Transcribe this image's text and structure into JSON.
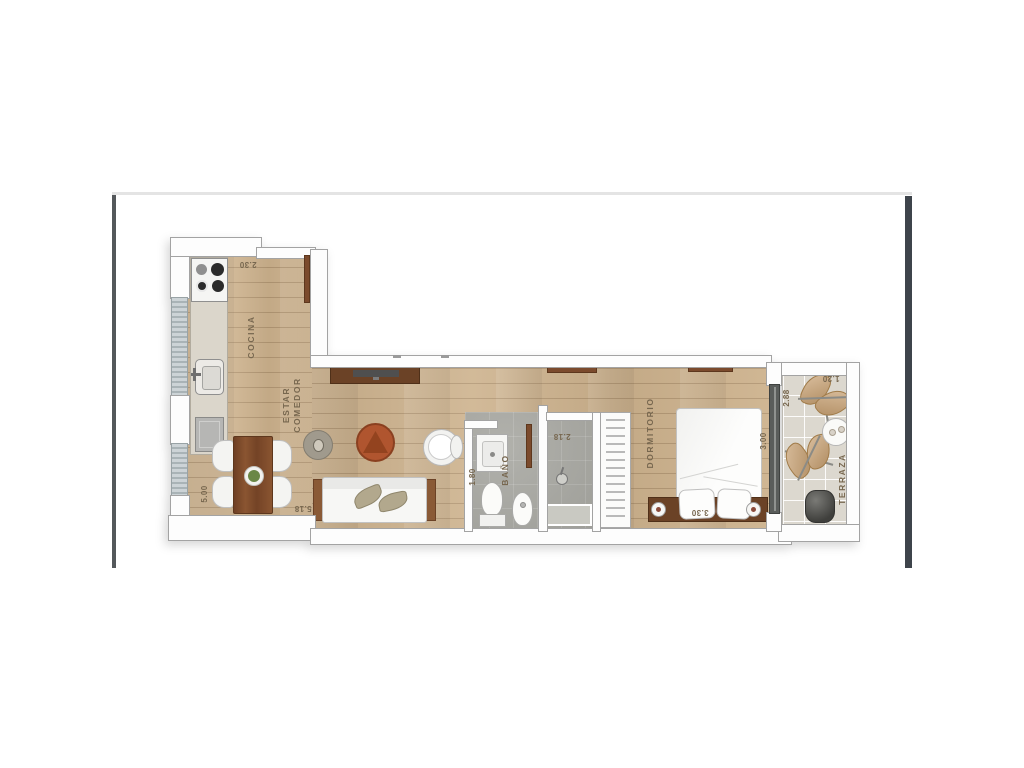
{
  "image_type": "apartment-floorplan-photo",
  "rooms": {
    "cocina": {
      "name": "COCINA",
      "width": "2.30"
    },
    "estar_comedor": {
      "name_line1": "ESTAR",
      "name_line2": "COMEDOR",
      "height": "5.00",
      "width": "5.18"
    },
    "bano": {
      "name": "BAÑO",
      "width": "1.80"
    },
    "ducha": {
      "width": "2.18"
    },
    "dormitorio": {
      "name": "DORMITORIO",
      "width": "3.30",
      "depth": "3.00"
    },
    "terraza": {
      "name": "TERRAZA",
      "height": "2.88",
      "width": "1.20"
    }
  },
  "furniture": [
    "stove-cooktop",
    "kitchen-sink",
    "kitchen-appliance",
    "kitchen-counter",
    "dining-table",
    "dining-chair",
    "plant-centerpiece",
    "side-table-lamp",
    "coffee-table",
    "armchair",
    "sofa",
    "sofa-cushion",
    "sofa-side-table",
    "tv-console",
    "tv",
    "wall-shelf",
    "vanity-sink",
    "toilet",
    "bidet",
    "shower-head",
    "shower-tray",
    "wardrobe-closet",
    "double-bed",
    "pillow",
    "headboard",
    "nightstand-lamp",
    "butterfly-chair",
    "terrace-table",
    "planter",
    "entry-door",
    "bathroom-door",
    "sliding-glass-door",
    "window"
  ],
  "colors": {
    "wood": "#cdb28d",
    "wall-fill": "#fdfdfd",
    "wall-line": "#a3a3a3",
    "tile-bath": "#a8a8a2",
    "tile-terrace": "#dcd8cf",
    "window-glass": "#ccd3d6",
    "furniture-wood": "#7b4a2c",
    "furniture-wood-dark": "#6b4226",
    "coffee-table": "#b0552f",
    "label": "#77674f",
    "photo-bar-left": "#54585b",
    "photo-bar-right": "#3e444b",
    "photo-top-line": "#e4e4e4",
    "glass-door": "#5a5d5b",
    "chair-fabric": "#c89f6e"
  }
}
